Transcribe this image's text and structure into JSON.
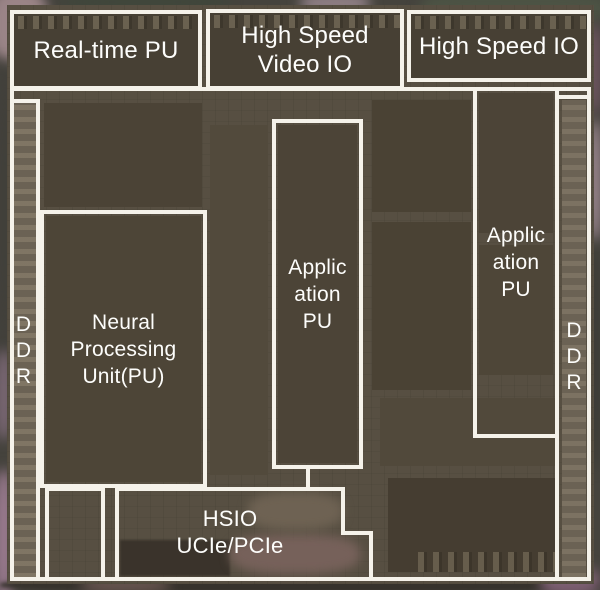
{
  "title": "Annotated chip die photograph (floorplan)",
  "blocks": {
    "realtime_pu": {
      "lines": [
        "Real-time PU"
      ]
    },
    "high_speed_video_io": {
      "lines": [
        "High Speed",
        "Video IO"
      ]
    },
    "high_speed_io": {
      "lines": [
        "High Speed IO"
      ]
    },
    "npu": {
      "lines": [
        "Neural",
        "Processing",
        "Unit(PU)"
      ]
    },
    "apu_center": {
      "lines": [
        "Applic",
        "ation",
        "PU"
      ]
    },
    "apu_right": {
      "lines": [
        "Applic",
        "ation",
        "PU"
      ]
    },
    "hsio": {
      "lines": [
        "HSIO",
        "UCIe/PCIe"
      ]
    },
    "ddr_left": {
      "letters": [
        "D",
        "D",
        "R"
      ]
    },
    "ddr_right": {
      "letters": [
        "D",
        "D",
        "R"
      ]
    }
  },
  "colors": {
    "outline_white": "#f5f2ea",
    "label_text": "#fdfdfb",
    "die_base": "#574f42",
    "block_dark": "#4a4235",
    "ddr_strip": "#6b6254",
    "margin_pink": "#a08a93",
    "margin_green": "#4c5344",
    "bottom_edge_dark": "#36322c"
  }
}
